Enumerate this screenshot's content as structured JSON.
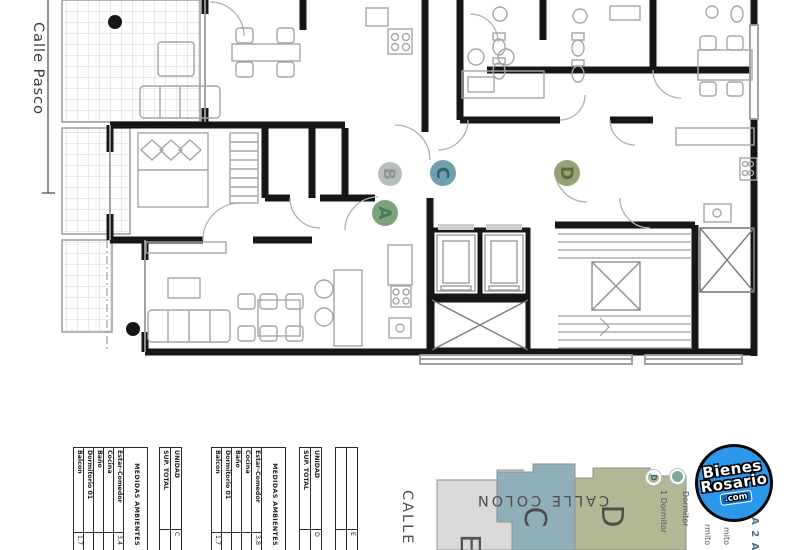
{
  "plan": {
    "street_label": "Calle Pasco",
    "unit_markers": [
      {
        "letter": "A",
        "fill": "#7ca37c",
        "text_color": "#4d7a50"
      },
      {
        "letter": "B",
        "fill": "#b8bebe",
        "text_color": "#8d9797"
      },
      {
        "letter": "C",
        "fill": "#70a0af",
        "text_color": "#35606e"
      },
      {
        "letter": "D",
        "fill": "#96a175",
        "text_color": "#5c6b42"
      }
    ]
  },
  "tables": {
    "medidas_header": "MEDIDAS AMBIENTES",
    "room_rows": [
      "Estar-Comedor",
      "Cocina",
      "Baño",
      "Dormitorio 01",
      "Balcon"
    ],
    "unidad_label": "UNIDAD",
    "sup_total_label": "SUP. TOTAL",
    "groups": [
      {
        "values": [
          "3,4",
          "",
          "",
          "",
          "1,7"
        ],
        "unidad": "C",
        "sup_total": ""
      },
      {
        "values": [
          "3,8",
          "",
          "",
          "",
          "1,7"
        ],
        "unidad": "D",
        "sup_total": ""
      }
    ],
    "third_unidad": "E"
  },
  "keyplan": {
    "street_top": "CALLE COLON",
    "street_left": "CALLE",
    "blocks": [
      {
        "label": "C",
        "color": "#8fafba"
      },
      {
        "label": "D",
        "color": "#b2b893"
      },
      {
        "label": "E",
        "color": "#d9d9d9"
      }
    ],
    "legend": [
      {
        "letter": "D",
        "text": "1 Dormitor",
        "color": "#9db1bd",
        "letter_color": "#3d6275"
      },
      {
        "letter": "",
        "text": "Dormitor",
        "color": "#83a89b",
        "letter_color": "#3d6f5e"
      },
      {
        "letter": "",
        "text": "rmito",
        "color": "",
        "letter_color": ""
      },
      {
        "letter": "",
        "text": "mito",
        "color": "",
        "letter_color": ""
      }
    ],
    "side_text": "A 2 A"
  },
  "logo": {
    "line1": "Bienes",
    "line2": "Rosario",
    "line3": ".com"
  }
}
